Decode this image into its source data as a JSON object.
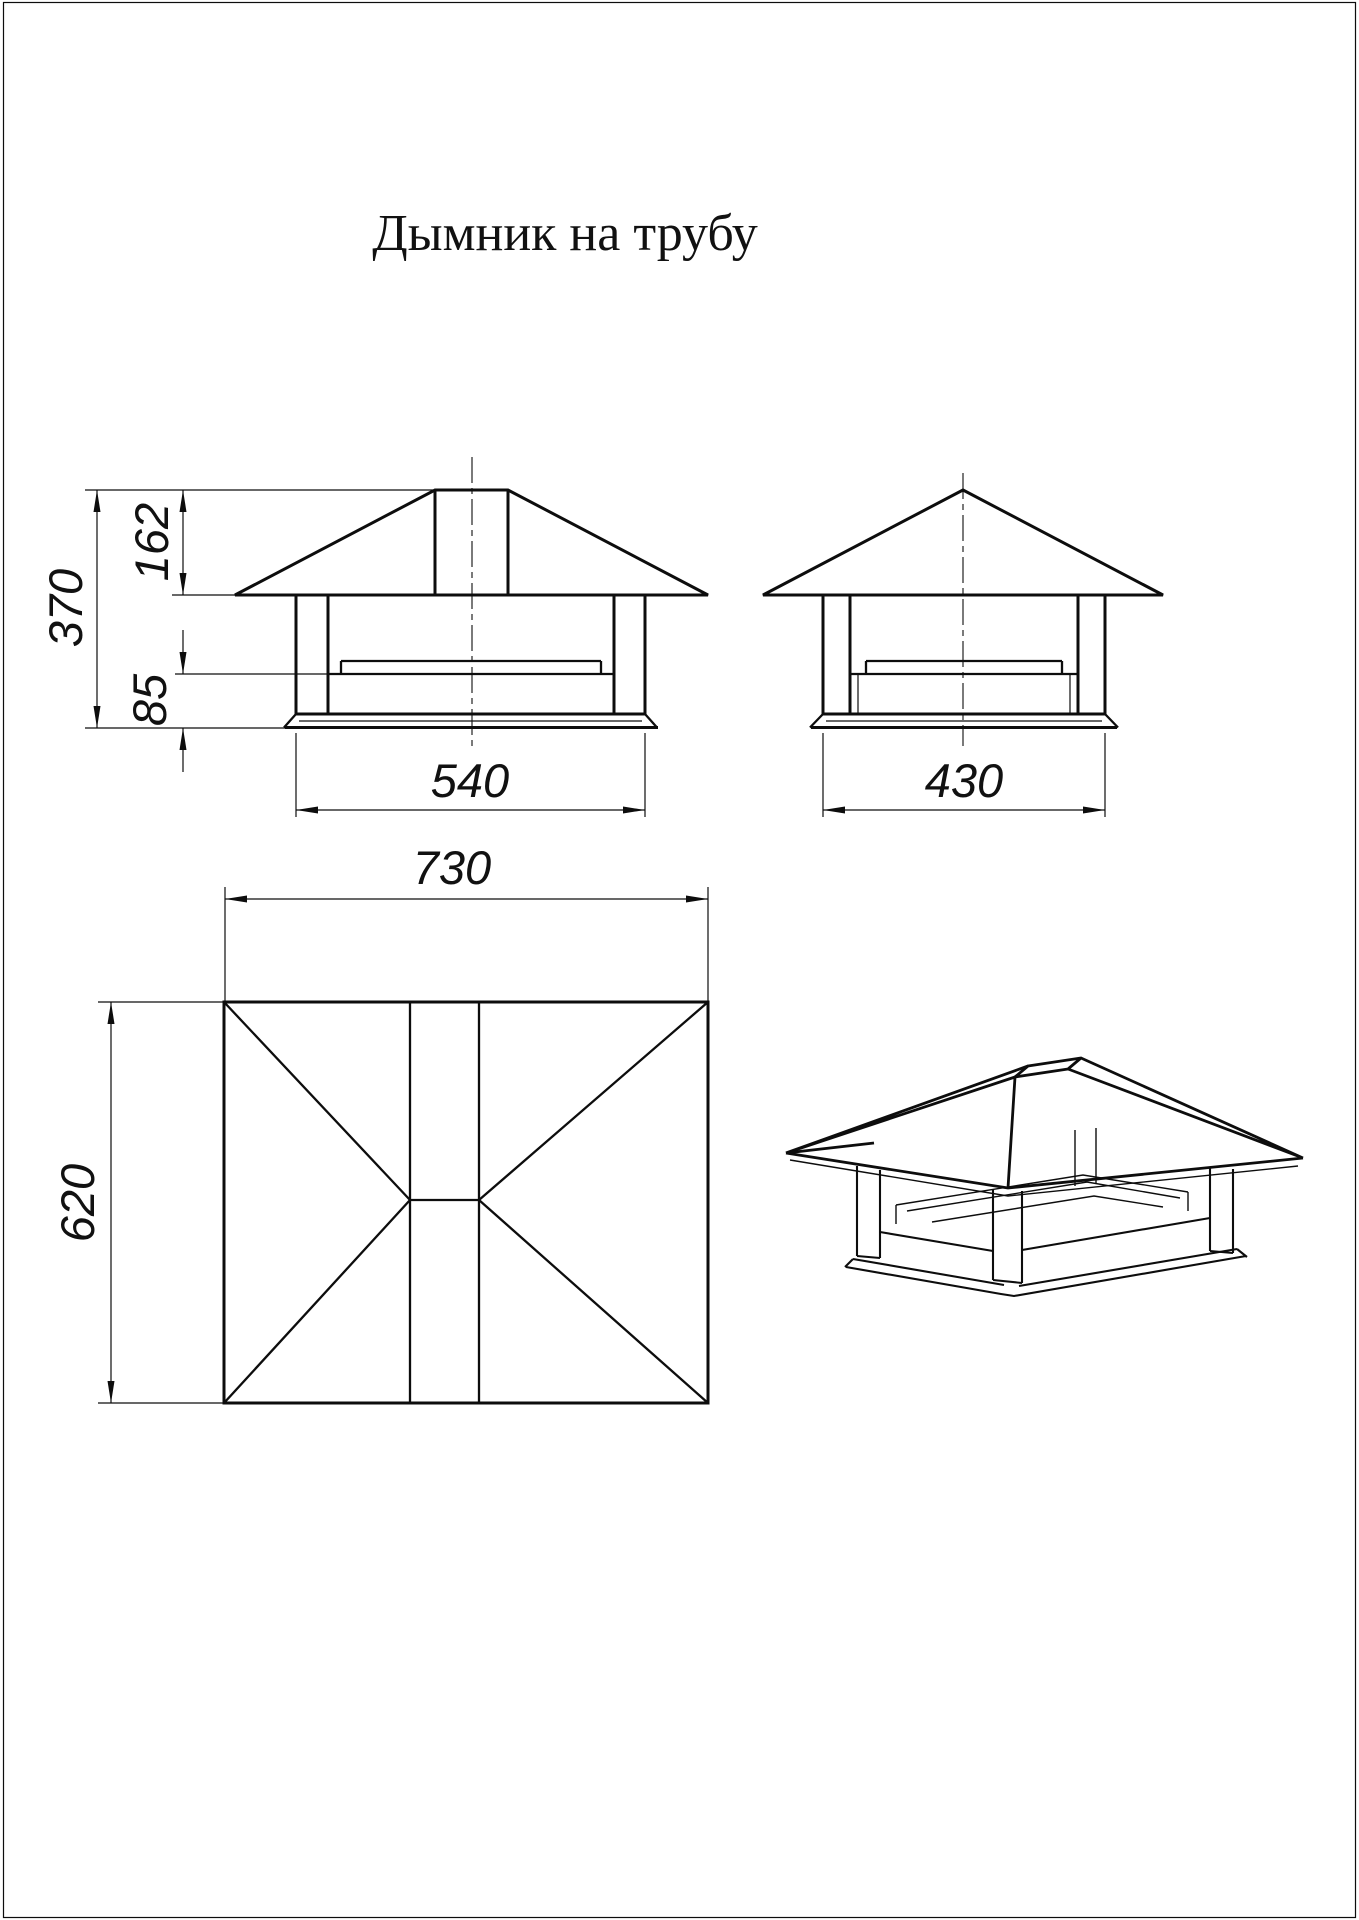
{
  "page": {
    "title": "Дымник на трубу",
    "background_color": "#ffffff",
    "line_color": "#0d0d0d"
  },
  "dimensions": {
    "total_height": "370",
    "roof_height": "162",
    "base_height": "85",
    "base_width_front": "540",
    "base_width_side": "430",
    "plan_width": "730",
    "plan_depth": "620"
  }
}
